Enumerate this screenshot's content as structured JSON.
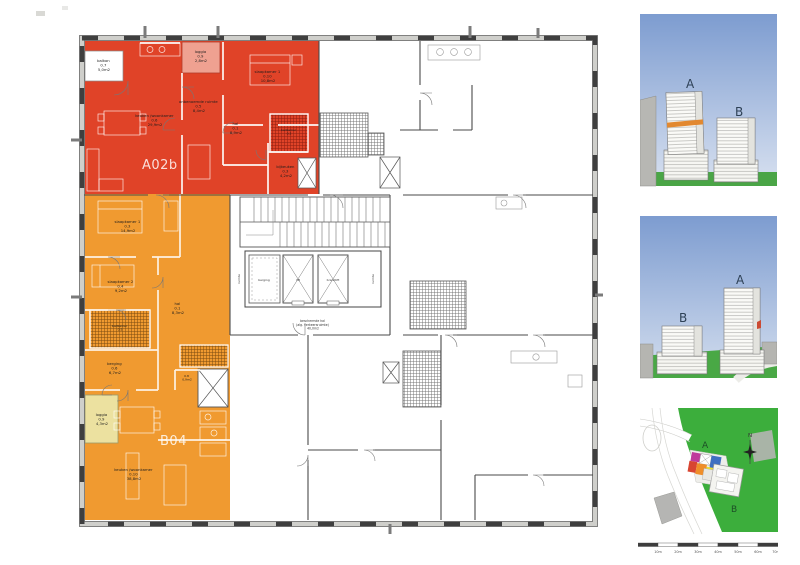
{
  "plan": {
    "unit_a": {
      "label": "A02b",
      "rooms": {
        "balkon": {
          "name": "balkon",
          "num": "0.7",
          "area": "5,0m2"
        },
        "loggia": {
          "name": "loggia",
          "num": "0.9",
          "area": "2,8m2"
        },
        "woonkamer": {
          "name": "keuken /woonkamer",
          "num": "0.6",
          "area": "29,9m2"
        },
        "onbenoemd": {
          "name": "onbenoemde ruimte",
          "num": "0.5",
          "area": "8,4m2"
        },
        "slaapkamer1": {
          "name": "slaapkamer 1",
          "num": "0.10",
          "area": "10,8m2"
        },
        "hal": {
          "name": "hal",
          "num": "0.1",
          "area": "8,9m2"
        },
        "badkamer": {
          "name": "badkamer",
          "num": "0.2",
          "area": "4,6m2"
        },
        "bijkeuken": {
          "name": "bijkeuken",
          "num": "0.3",
          "area": "4,2m2"
        }
      }
    },
    "unit_b": {
      "label": "B04",
      "rooms": {
        "slaapkamer1": {
          "name": "slaapkamer 1",
          "num": "0.3",
          "area": "14,9m2"
        },
        "slaapkamer2": {
          "name": "slaapkamer 2",
          "num": "0.4",
          "area": "9,2m2"
        },
        "hal": {
          "name": "hal",
          "num": "0.1",
          "area": "8,3m2"
        },
        "badkamer": {
          "name": "badkamer",
          "num": "0.5",
          "area": "5,2m2"
        },
        "berging": {
          "name": "berging",
          "num": "0.6",
          "area": "6,7m2"
        },
        "mk": {
          "name": "mk",
          "num": "0.8",
          "area": "0,9m2"
        },
        "loggia": {
          "name": "loggia",
          "num": "0.9",
          "area": "4,3m2"
        },
        "woonkamer": {
          "name": "keuken /woonkamer",
          "num": "0.10",
          "area": "38,8m2"
        }
      }
    },
    "core": {
      "berging_label": "berging",
      "lift_left": "lift",
      "lift_right": "brandlift",
      "ruimte_left": "ruimte",
      "ruimte_right": "ruimte",
      "hal": {
        "line1": "beschermde hal",
        "line2": "(alg. verkeersruimte)",
        "line3": "40,0m2"
      }
    }
  },
  "renders": {
    "top": {
      "label_a": "A",
      "label_b": "B"
    },
    "middle": {
      "label_a": "A",
      "label_b": "B"
    }
  },
  "sitemap": {
    "label_a": "A",
    "label_b": "B",
    "north_label": "N"
  },
  "scalebar": {
    "labels": [
      "10m",
      "20m",
      "30m",
      "40m",
      "50m",
      "60m",
      "70m"
    ]
  },
  "colors": {
    "unit_a_red": "#e04328",
    "unit_a_loggia": "#efa191",
    "unit_b_orange": "#f09a30",
    "unit_b_loggia": "#ece1a0",
    "site_green": "#3cae3c",
    "grass_green": "#4aa546",
    "sky_top": "#7d9cd0",
    "sky_bottom": "#d8e1f0",
    "tower_band_orange": "#e2882f",
    "site_magenta": "#bf3a9b",
    "site_blue": "#3f6fc2",
    "site_yellow": "#efdf2e",
    "site_red": "#d84531",
    "site_orange": "#ef8e2a"
  }
}
